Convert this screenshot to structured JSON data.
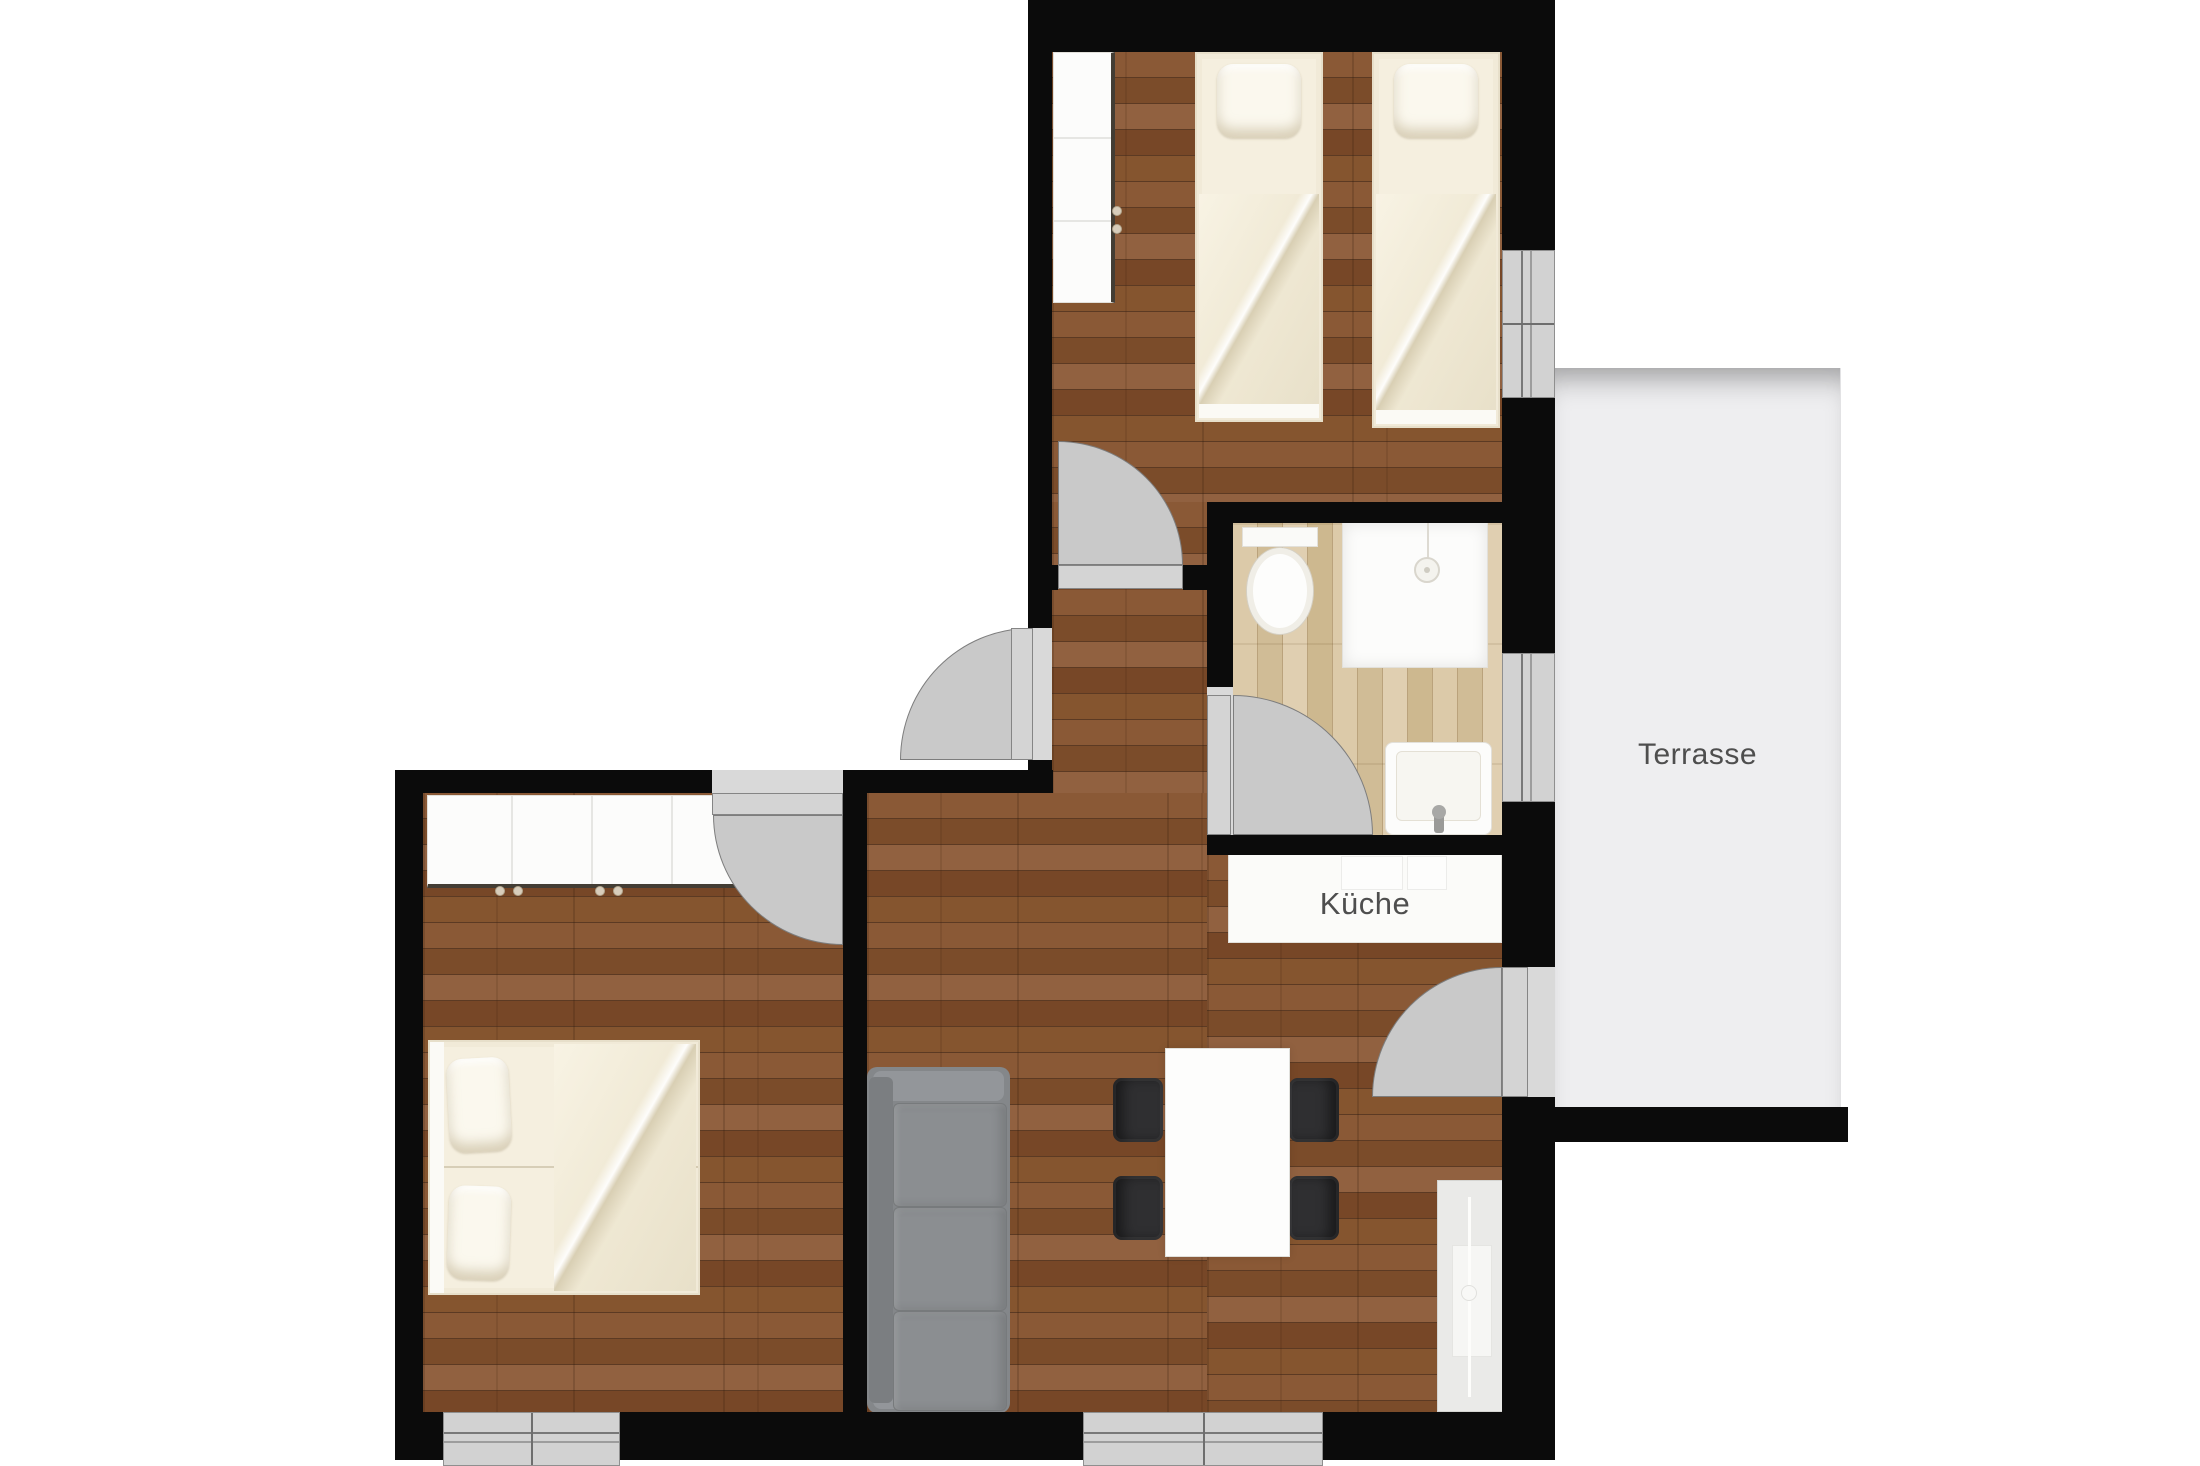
{
  "title": "Apartment floor plan",
  "labels": {
    "kitchen": "Küche",
    "terrace": "Terrasse"
  },
  "colors": {
    "wall": "#0b0b0b",
    "floor_dark_wood": "#7f5130",
    "floor_light_wood": "#d6c2a0",
    "terrace_floor": "#eeeef0",
    "door_leaf": "#d4d4d4",
    "door_arc": "#c9c9c9",
    "window": "#d2d2d2",
    "sofa": "#85888a",
    "chair": "#2f2f31",
    "bedding": "#f3edde",
    "label_text": "#4e4e4e",
    "background": "#ffffff"
  },
  "rooms": [
    {
      "name": "bedroom-top",
      "furniture": [
        "wardrobe",
        "single-bed",
        "single-bed"
      ]
    },
    {
      "name": "bathroom",
      "furniture": [
        "toilet",
        "shower",
        "sink"
      ]
    },
    {
      "name": "hallway",
      "furniture": []
    },
    {
      "name": "bedroom-left",
      "furniture": [
        "wardrobe",
        "double-bed"
      ]
    },
    {
      "name": "living-room",
      "furniture": [
        "sofa",
        "dining-table",
        "chair",
        "chair",
        "chair",
        "chair",
        "kitchen-counter",
        "tv-sideboard"
      ]
    },
    {
      "name": "terrace",
      "furniture": []
    }
  ]
}
